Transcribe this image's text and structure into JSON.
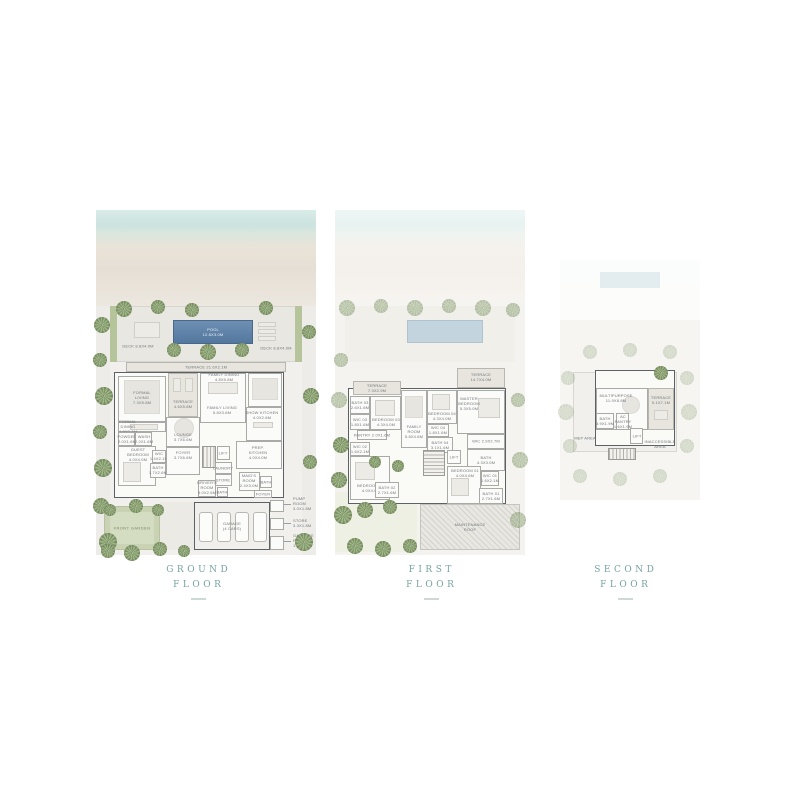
{
  "colors": {
    "accent_teal": "#76a3a0",
    "pool_blue": "#54779e",
    "palm_green": "#8aa073",
    "wall_grey": "#5c6165"
  },
  "titles": {
    "ground": {
      "line1": "GROUND",
      "line2": "FLOOR"
    },
    "first": {
      "line1": "FIRST",
      "line2": "FLOOR"
    },
    "second": {
      "line1": "SECOND",
      "line2": "FLOOR"
    }
  },
  "g": {
    "labels": {
      "pool": "POOL\n12.8X3.0M",
      "deck_left": "DECK 8.8X4.0M",
      "deck_right": "DECK 8.8X4.0M",
      "terrace_main": "TERRACE 21.6X2.1M",
      "formal_living": "FORMAL\nLIVING\n7.3X5.8M",
      "terrace_inner": "TERRACE\n4.6X5.8M",
      "family_dining": "FAMILY DINING\n4.8X5.8M",
      "family_living": "FAMILY LIVING\n5.8X3.6M",
      "lounge": "LOUNGE\n3.7X6.6M",
      "formal_dining": "FORMAL\nDINING\n4.6X2.1M",
      "powder": "POWDER\n2.0X1.6M",
      "wash": "WASH\n2.2X1.6M",
      "guest_bedroom": "GUEST\nBEDROOM\n4.0X4.0M",
      "wic": "WIC\n1.4X2.1M",
      "bath": "BATH\n1.7X2.6M",
      "foyer": "FOYER\n3.7X6.6M",
      "show_kitchen": "SHOW KITCHEN\n4.0X2.6M",
      "prep_kitchen": "PREP.\nKITCHEN\n4.0X4.0M",
      "lift": "LIFT",
      "laundry": "LAUNDRY",
      "store": "STORE",
      "drivers_room": "DRIVER'S\nROOM\n3.0X2.6M",
      "bath_driver": "BATH",
      "maids_room": "MAID'S\nROOM\n2.4X3.0M",
      "bath_maid": "BATH",
      "entry": "FOYER",
      "garage": "GARAGE\n(4 CARS)",
      "front_garden": "FRONT GARDEN",
      "pump_room": "PUMP ROOM\n3.0X1.8M",
      "store_ext": "STORE\n3.3X1.8M",
      "garbage_room": "GARBAGE\nROOM\n1.4X1.8M"
    }
  },
  "f1": {
    "labels": {
      "terrace_left": "TERRACE\n7.3X2.9M",
      "bath_03": "BATH 03\n2.6X1.6M",
      "wic_03": "WIC 03\n1.8X1.6M",
      "bedroom_03": "BEDROOM 03\n4.3X4.0M",
      "pantry": "PANTRY 2.0X1.6M",
      "family_room": "FAMILY\nROOM\n5.8X4.6M",
      "bedroom_04": "BEDROOM 04\n4.3X4.0M",
      "wic_04": "WIC 04\n1.8X1.6M",
      "bath_04": "BATH 04\n3.1X1.6M",
      "master_bedroom": "MASTER\nBEDROOM\n5.3X5.0M",
      "terrace_master": "TERRACE\n14.7X4.0M",
      "wic_master": "WIC 2.9X2.7M",
      "bath_master": "BATH\n4.3X3.0M",
      "wic_02": "WIC 02\n1.6X2.1M",
      "bedroom_02": "BEDROOM 02\n4.0X4.6M",
      "bath_02": "BATH 02\n2.7X1.6M",
      "lift": "LIFT",
      "bedroom_01": "BEDROOM 01\n4.0X4.6M",
      "wic_01": "WIC 01\n1.6X2.1M",
      "bath_01": "BATH 01\n2.7X1.6M",
      "maintenance_roof": "MAINTENANCE\nROOF"
    }
  },
  "f2": {
    "labels": {
      "terrace_top": "TERRACE\n14.8X4.0M",
      "terrace_right": "TERRACE\n5.1X7.1M",
      "multipurpose": "MULTIPURPOSE\n11.9X8.8M",
      "bath": "BATH\n3.9X1.9M",
      "ac_pantry": "AC\nPANTRY\n1.6X1.9M",
      "lift": "LIFT",
      "mep_area": "MEP AREA",
      "inaccessible": "INACCESSIBLE\nAREA"
    }
  }
}
